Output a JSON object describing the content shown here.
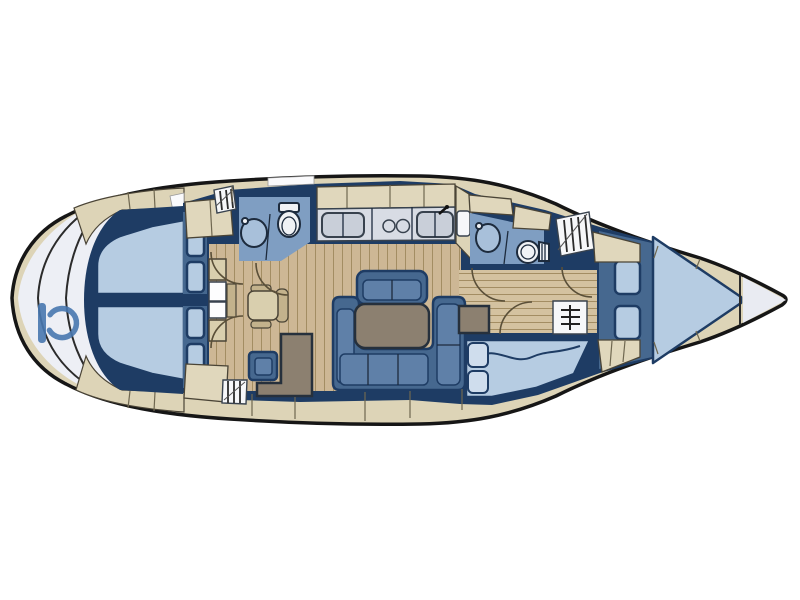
{
  "meta": {
    "title": "Sailing yacht interior layout plan",
    "view": "top-down deck plan",
    "orientation": {
      "bow": "right",
      "stern": "left"
    }
  },
  "palette": {
    "hull_outline": "#161616",
    "deck": "#ddd4b7",
    "deck_seam": "#6f6750",
    "wall": "#1e3c64",
    "furniture": "#46688f",
    "cushion": "#5f80a8",
    "berth": "#b6cce2",
    "pillow": "#cfdded",
    "heads_floor": "#7f9ec2",
    "fixture_white": "#f0f2f5",
    "fixture_blue": "#a8c0da",
    "counter": "#d8dce4",
    "counter_unit": "#c9cfd9",
    "locker_beige": "#e0d7bc",
    "floor_wood": "#cdb795",
    "floor_wood_light": "#d4c2a0",
    "plank_line": "#a38d63",
    "table": "#8c8070",
    "chair": "#d9cfae",
    "chair_dark": "#c3b28c",
    "platform": "#edeff5",
    "bow_locker": "#e9ebf2",
    "hatch_panel": "#f6f7f9",
    "line_dark": "#2b2b2b",
    "logo": "#4878b0"
  },
  "diagram": {
    "type": "yacht-interior-floor-plan",
    "rooms": [
      {
        "name": "stern-platform",
        "features": [
          "brand-logo-glyph",
          "transom-arcs"
        ]
      },
      {
        "name": "aft-cabin-port",
        "features": [
          "double-berth",
          "storage-cubbies"
        ]
      },
      {
        "name": "aft-cabin-starboard",
        "features": [
          "double-berth",
          "storage-cubbies"
        ]
      },
      {
        "name": "nav-station",
        "features": [
          "chart-table",
          "swivel-seat",
          "door-arcs"
        ]
      },
      {
        "name": "aft-heads",
        "features": [
          "washbasin",
          "toilet"
        ]
      },
      {
        "name": "galley",
        "features": [
          "double-sink",
          "two-burner-stove",
          "icebox",
          "overhead-lockers"
        ]
      },
      {
        "name": "saloon",
        "features": [
          "u-settee",
          "dining-table",
          "side-bench",
          "stool",
          "sideboard",
          "plank-floor"
        ]
      },
      {
        "name": "forward-heads",
        "features": [
          "washbasin",
          "toilet"
        ]
      },
      {
        "name": "corridor",
        "features": [
          "door-arcs",
          "shelf-unit",
          "locker"
        ]
      },
      {
        "name": "forward-cabin-starboard",
        "features": [
          "double-berth",
          "blanket-wave",
          "pillows"
        ]
      },
      {
        "name": "bow-cabin",
        "features": [
          "v-berth",
          "two-cushions"
        ]
      },
      {
        "name": "bow-tip",
        "features": [
          "anchor-locker"
        ]
      }
    ],
    "icons": [
      "toilet-icon",
      "washbasin-icon",
      "stove-burners-icon",
      "sink-icon",
      "deck-hatch-icon",
      "shelf-unit-icon",
      "door-swing-arc",
      "brand-logo-glyph"
    ],
    "hatch_count": 3,
    "door_arc_count": 6
  }
}
